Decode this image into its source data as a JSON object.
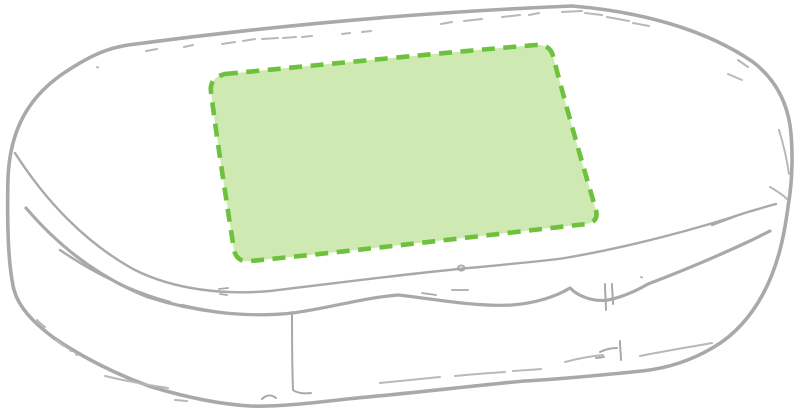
{
  "illustration": {
    "subject": "pillbox-sketch",
    "view": "top-perspective",
    "print_area_name": "print-area-highlight"
  },
  "colors": {
    "background": "#ffffff",
    "sketch_gray": "#a9a9a9",
    "sketch_gray_light": "#b8b8b8",
    "print_area_fill": "#cfe9b3",
    "print_area_stroke": "#6ec13c"
  },
  "print_area": {
    "shape": "rounded-rectangle",
    "border_style": "dashed",
    "corners_px": {
      "top_left": [
        208,
        77
      ],
      "top_right": [
        553,
        45
      ],
      "bottom_right": [
        598,
        223
      ],
      "bottom_left": [
        233,
        261
      ]
    }
  }
}
